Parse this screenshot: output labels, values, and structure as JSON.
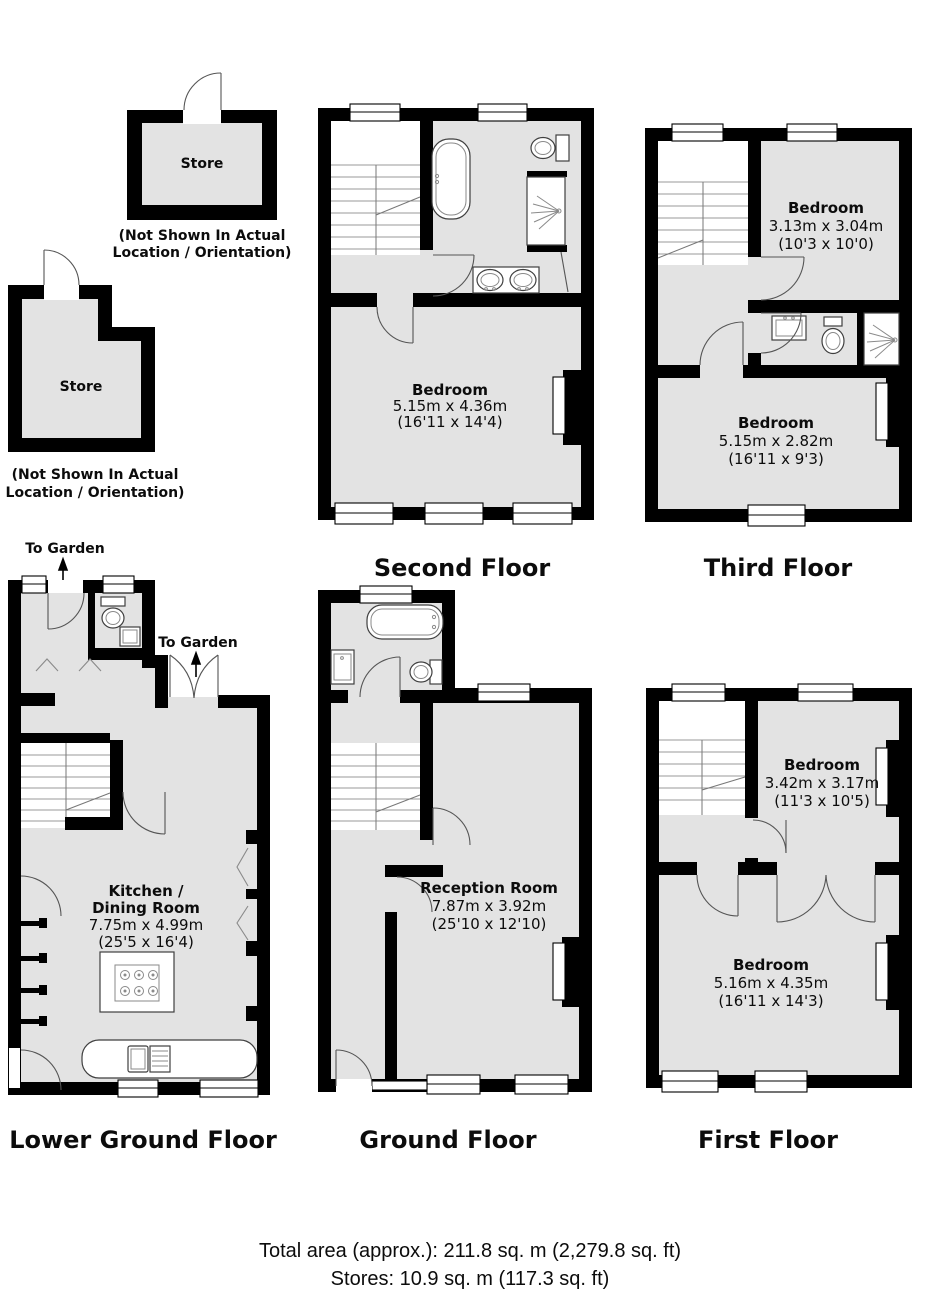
{
  "colors": {
    "wall": "#000000",
    "room_fill": "#e3e3e3",
    "background": "#ffffff",
    "door_stroke": "#555555"
  },
  "stores": [
    {
      "name": "Store",
      "note": [
        "(Not Shown In Actual",
        "Location / Orientation)"
      ]
    },
    {
      "name": "Store",
      "note": [
        "(Not Shown In Actual",
        "Location / Orientation)"
      ]
    }
  ],
  "floors": [
    {
      "id": "second-floor",
      "label": "Second Floor",
      "rooms": [
        {
          "name": "Bedroom",
          "metric": "5.15m x 4.36m",
          "imperial": "(16'11 x 14'4)"
        }
      ]
    },
    {
      "id": "third-floor",
      "label": "Third Floor",
      "rooms": [
        {
          "name": "Bedroom",
          "metric": "3.13m x 3.04m",
          "imperial": "(10'3 x 10'0)"
        },
        {
          "name": "Bedroom",
          "metric": "5.15m x 2.82m",
          "imperial": "(16'11 x 9'3)"
        }
      ]
    },
    {
      "id": "lower-ground-floor",
      "label": "Lower Ground Floor",
      "annotations": [
        "To Garden",
        "To Garden"
      ],
      "rooms": [
        {
          "name": "Kitchen /",
          "name2": "Dining Room",
          "metric": "7.75m x 4.99m",
          "imperial": "(25'5 x 16'4)"
        }
      ]
    },
    {
      "id": "ground-floor",
      "label": "Ground Floor",
      "rooms": [
        {
          "name": "Reception Room",
          "metric": "7.87m x 3.92m",
          "imperial": "(25'10 x 12'10)"
        }
      ]
    },
    {
      "id": "first-floor",
      "label": "First Floor",
      "rooms": [
        {
          "name": "Bedroom",
          "metric": "3.42m x 3.17m",
          "imperial": "(11'3 x 10'5)"
        },
        {
          "name": "Bedroom",
          "metric": "5.16m x 4.35m",
          "imperial": "(16'11 x 14'3)"
        }
      ]
    }
  ],
  "summary": {
    "total_area": "Total area (approx.): 211.8 sq. m (2,279.8 sq. ft)",
    "stores": "Stores: 10.9 sq. m (117.3 sq. ft)"
  }
}
